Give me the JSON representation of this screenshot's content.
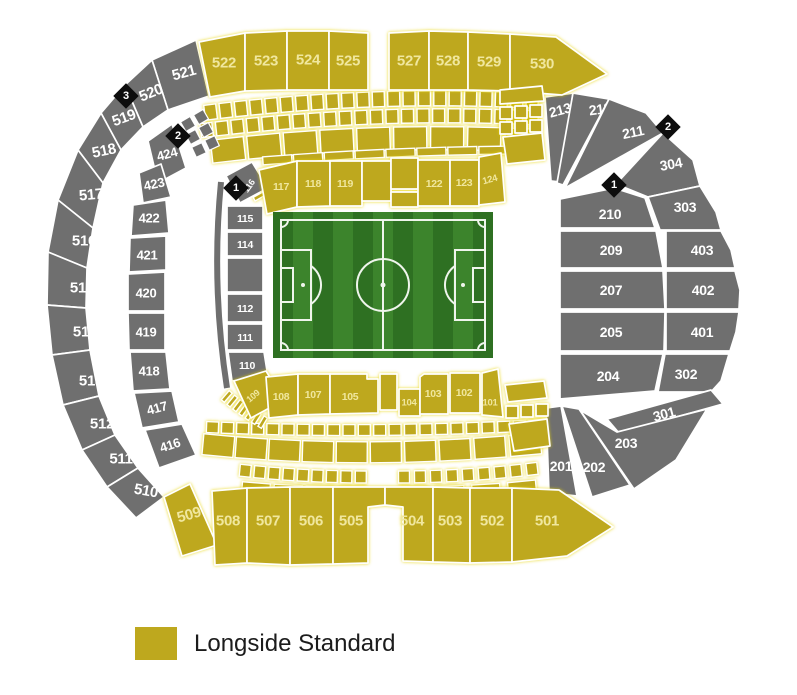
{
  "legend": {
    "items": [
      {
        "label": "Longside Standard",
        "color": "#BEA81E"
      }
    ]
  },
  "colors": {
    "standard": "#BEA81E",
    "standard_label": "#F0E79E",
    "unavailable": "#6F6F6F",
    "unavailable_label": "#FFFFFF",
    "marker_bg": "#0D0D0D",
    "marker_label": "#FFFFFF",
    "pitch_dark": "#2E7022",
    "pitch_light": "#3C842C",
    "pitch_line": "#EFF5EC"
  },
  "map": {
    "sections": [
      {
        "label": "522",
        "type": "standard",
        "pts": "199,42 245,33 245,91 210,97",
        "lx": 224,
        "ly": 63,
        "rot": 0,
        "fs": 15
      },
      {
        "label": "523",
        "type": "standard",
        "pts": "245,33 287,31 287,90 245,91",
        "lx": 266,
        "ly": 61,
        "rot": 0,
        "fs": 15
      },
      {
        "label": "524",
        "type": "standard",
        "pts": "287,31 329,31 329,90 287,90",
        "lx": 308,
        "ly": 60,
        "rot": 0,
        "fs": 15
      },
      {
        "label": "525",
        "type": "standard",
        "pts": "329,31 368,33 368,90 329,90",
        "lx": 348,
        "ly": 61,
        "rot": 0,
        "fs": 15
      },
      {
        "label": "527",
        "type": "standard",
        "pts": "389,33 429,31 429,90 389,90",
        "lx": 409,
        "ly": 61,
        "rot": 0,
        "fs": 15
      },
      {
        "label": "528",
        "type": "standard",
        "pts": "429,31 468,32 468,90 429,90",
        "lx": 448,
        "ly": 61,
        "rot": 0,
        "fs": 15
      },
      {
        "label": "529",
        "type": "standard",
        "pts": "468,32 510,34 510,91 468,90",
        "lx": 489,
        "ly": 62,
        "rot": 0,
        "fs": 15
      },
      {
        "label": "530",
        "type": "standard",
        "pts": "510,34 556,37 607,74 562,95 510,91",
        "lx": 542,
        "ly": 64,
        "rot": 0,
        "fs": 15
      },
      {
        "label": "521",
        "type": "unavailable",
        "pts": "152,60 196,40 209,96 168,110",
        "lx": 184,
        "ly": 73,
        "rot": -15,
        "fs": 15
      },
      {
        "label": "520",
        "type": "unavailable",
        "pts": "125,85 152,60 168,110 143,127",
        "lx": 151,
        "ly": 93,
        "rot": -22,
        "fs": 15
      },
      {
        "label": "519",
        "type": "unavailable",
        "pts": "101,113 125,85 143,127 121,150",
        "lx": 124,
        "ly": 118,
        "rot": -20,
        "fs": 15
      },
      {
        "label": "518",
        "type": "unavailable",
        "pts": "78,150 101,113 121,150 103,183",
        "lx": 104,
        "ly": 151,
        "rot": -12,
        "fs": 15
      },
      {
        "label": "517",
        "type": "unavailable",
        "pts": "58,200 78,150 103,183 93,228",
        "lx": 91,
        "ly": 195,
        "rot": -5,
        "fs": 15
      },
      {
        "label": "516",
        "type": "unavailable",
        "pts": "48,252 58,200 93,228 87,268",
        "lx": 84,
        "ly": 241,
        "rot": 0,
        "fs": 15
      },
      {
        "label": "515",
        "type": "unavailable",
        "pts": "47,305 48,252 87,268 86,308",
        "lx": 82,
        "ly": 288,
        "rot": 0,
        "fs": 15
      },
      {
        "label": "514",
        "type": "unavailable",
        "pts": "52,355 47,305 86,308 90,350",
        "lx": 85,
        "ly": 332,
        "rot": 0,
        "fs": 15
      },
      {
        "label": "513",
        "type": "unavailable",
        "pts": "63,405 52,355 90,350 99,396",
        "lx": 91,
        "ly": 381,
        "rot": 0,
        "fs": 15
      },
      {
        "label": "512",
        "type": "unavailable",
        "pts": "82,450 63,405 99,396 115,435",
        "lx": 102,
        "ly": 424,
        "rot": 0,
        "fs": 15
      },
      {
        "label": "511",
        "type": "unavailable",
        "pts": "107,487 82,450 115,435 138,468",
        "lx": 121,
        "ly": 459,
        "rot": 0,
        "fs": 15
      },
      {
        "label": "510",
        "type": "unavailable",
        "pts": "136,518 107,487 138,468 164,497",
        "lx": 146,
        "ly": 491,
        "rot": 10,
        "fs": 15
      },
      {
        "label": "509",
        "type": "standard",
        "pts": "164,497 190,484 217,545 182,556",
        "lx": 189,
        "ly": 515,
        "rot": -16,
        "fs": 15
      },
      {
        "label": "508",
        "type": "standard",
        "pts": "212,491 247,488 247,563 215,565",
        "lx": 228,
        "ly": 521,
        "rot": 0,
        "fs": 15
      },
      {
        "label": "507",
        "type": "standard",
        "pts": "247,488 290,487 290,565 247,563",
        "lx": 268,
        "ly": 521,
        "rot": 0,
        "fs": 15
      },
      {
        "label": "506",
        "type": "standard",
        "pts": "290,487 333,487 333,564 290,565",
        "lx": 311,
        "ly": 521,
        "rot": 0,
        "fs": 15
      },
      {
        "label": "505",
        "type": "standard",
        "pts": "333,487 385,487 385,505 368,507 368,563 333,564",
        "lx": 351,
        "ly": 521,
        "rot": 0,
        "fs": 15
      },
      {
        "label": "504",
        "type": "standard",
        "pts": "385,487 433,487 433,562 403,561 403,507 385,505",
        "lx": 412,
        "ly": 521,
        "rot": 0,
        "fs": 15
      },
      {
        "label": "503",
        "type": "standard",
        "pts": "433,487 470,488 470,563 433,562",
        "lx": 450,
        "ly": 521,
        "rot": 0,
        "fs": 15
      },
      {
        "label": "502",
        "type": "standard",
        "pts": "470,488 512,488 512,562 470,563",
        "lx": 492,
        "ly": 521,
        "rot": 0,
        "fs": 15
      },
      {
        "label": "501",
        "type": "standard",
        "pts": "512,488 559,490 613,527 567,556 512,562",
        "lx": 547,
        "ly": 521,
        "rot": 0,
        "fs": 15
      },
      {
        "label": "213",
        "type": "unavailable",
        "pts": "545,97 573,93 560,182 551,181",
        "lx": 560,
        "ly": 110,
        "rot": -15,
        "fs": 14
      },
      {
        "label": "212",
        "type": "unavailable",
        "pts": "573,93 609,99 563,185 557,183",
        "lx": 600,
        "ly": 109,
        "rot": -8,
        "fs": 14
      },
      {
        "label": "211",
        "type": "unavailable",
        "pts": "609,99 646,113 663,133 565,188",
        "lx": 633,
        "ly": 132,
        "rot": -12,
        "fs": 14
      },
      {
        "label": "304",
        "type": "unavailable",
        "pts": "663,133 693,160 700,186 648,197 616,184",
        "lx": 671,
        "ly": 164,
        "rot": -10,
        "fs": 14
      },
      {
        "label": "303",
        "type": "unavailable",
        "pts": "648,197 700,186 716,212 721,230 660,230",
        "lx": 685,
        "ly": 207,
        "rot": 0,
        "fs": 14
      },
      {
        "label": "210",
        "type": "unavailable",
        "pts": "560,199 614,188 645,198 655,228 560,228",
        "lx": 610,
        "ly": 214,
        "rot": 0,
        "fs": 14
      },
      {
        "label": "209",
        "type": "unavailable",
        "pts": "560,231 656,231 663,268 560,268",
        "lx": 611,
        "ly": 250,
        "rot": 0,
        "fs": 14
      },
      {
        "label": "403",
        "type": "unavailable",
        "pts": "666,231 721,231 731,250 735,268 666,268",
        "lx": 702,
        "ly": 250,
        "rot": 0,
        "fs": 14
      },
      {
        "label": "207",
        "type": "unavailable",
        "pts": "560,271 663,271 665,309 560,309",
        "lx": 611,
        "ly": 290,
        "rot": 0,
        "fs": 14
      },
      {
        "label": "402",
        "type": "unavailable",
        "pts": "666,271 735,271 740,290 739,309 666,309",
        "lx": 703,
        "ly": 290,
        "rot": 0,
        "fs": 14
      },
      {
        "label": "205",
        "type": "unavailable",
        "pts": "560,312 665,312 664,351 560,351",
        "lx": 611,
        "ly": 332,
        "rot": 0,
        "fs": 14
      },
      {
        "label": "401",
        "type": "unavailable",
        "pts": "666,312 739,312 736,332 730,351 666,351",
        "lx": 702,
        "ly": 332,
        "rot": 0,
        "fs": 14
      },
      {
        "label": "204",
        "type": "unavailable",
        "pts": "560,354 663,354 655,391 560,399",
        "lx": 608,
        "ly": 376,
        "rot": 0,
        "fs": 14
      },
      {
        "label": "302",
        "type": "unavailable",
        "pts": "665,354 729,354 721,381 711,392 658,392",
        "lx": 686,
        "ly": 374,
        "rot": 0,
        "fs": 14
      },
      {
        "label": "301",
        "type": "unavailable",
        "pts": "607,419 711,390 723,404 619,433",
        "lx": 664,
        "ly": 414,
        "rot": -15,
        "fs": 14
      },
      {
        "label": "203",
        "type": "unavailable",
        "pts": "580,410 617,432 707,409 676,460 634,489",
        "lx": 626,
        "ly": 443,
        "rot": 0,
        "fs": 14
      },
      {
        "label": "202",
        "type": "unavailable",
        "pts": "562,406 579,409 630,485 592,497",
        "lx": 594,
        "ly": 467,
        "rot": 0,
        "fs": 14
      },
      {
        "label": "201",
        "type": "unavailable",
        "pts": "546,408 561,406 577,496 549,493",
        "lx": 561,
        "ly": 466,
        "rot": 0,
        "fs": 14
      },
      {
        "label": "424",
        "type": "unavailable",
        "pts": "148,141 172,124 186,168 158,183",
        "lx": 167,
        "ly": 154,
        "rot": -15,
        "fs": 13
      },
      {
        "label": "423",
        "type": "unavailable",
        "pts": "139,173 161,164 171,197 143,203",
        "lx": 154,
        "ly": 184,
        "rot": -12,
        "fs": 13
      },
      {
        "label": "422",
        "type": "unavailable",
        "pts": "133,205 166,200 169,233 131,236",
        "lx": 149,
        "ly": 218,
        "rot": 0,
        "fs": 13
      },
      {
        "label": "421",
        "type": "unavailable",
        "pts": "130,238 166,236 166,270 129,272",
        "lx": 147,
        "ly": 255,
        "rot": 0,
        "fs": 13
      },
      {
        "label": "420",
        "type": "unavailable",
        "pts": "128,274 165,272 165,311 128,311",
        "lx": 146,
        "ly": 293,
        "rot": 0,
        "fs": 13
      },
      {
        "label": "419",
        "type": "unavailable",
        "pts": "128,313 165,313 165,350 129,350",
        "lx": 146,
        "ly": 332,
        "rot": 0,
        "fs": 13
      },
      {
        "label": "418",
        "type": "unavailable",
        "pts": "130,352 166,352 170,389 133,391",
        "lx": 149,
        "ly": 371,
        "rot": 0,
        "fs": 13
      },
      {
        "label": "417",
        "type": "unavailable",
        "pts": "134,393 172,391 179,422 142,428",
        "lx": 157,
        "ly": 408,
        "rot": -15,
        "fs": 13
      },
      {
        "label": "416",
        "type": "unavailable",
        "pts": "145,430 182,424 196,455 159,468",
        "lx": 170,
        "ly": 445,
        "rot": -18,
        "fs": 13
      },
      {
        "label": "116",
        "type": "unavailable",
        "pts": "226,176 252,162 268,188 240,203",
        "lx": 249,
        "ly": 186,
        "rot": -55,
        "fs": 9
      },
      {
        "label": "115",
        "type": "unavailable",
        "pts": "227,206 263,206 263,230 227,230",
        "lx": 245,
        "ly": 219,
        "rot": 0,
        "fs": 10.5
      },
      {
        "label": "114",
        "type": "unavailable",
        "pts": "227,232 263,232 263,256 227,256",
        "lx": 245,
        "ly": 245,
        "rot": 0,
        "fs": 10.5
      },
      {
        "label": "",
        "type": "unavailable",
        "pts": "227,258 263,258 263,292 227,292"
      },
      {
        "label": "112",
        "type": "unavailable",
        "pts": "227,294 263,294 263,322 227,322",
        "lx": 245,
        "ly": 309,
        "rot": 0,
        "fs": 10.5
      },
      {
        "label": "111",
        "type": "unavailable",
        "pts": "227,324 263,324 263,350 227,350",
        "lx": 245,
        "ly": 338,
        "rot": 0,
        "fs": 10.5
      },
      {
        "label": "110",
        "type": "unavailable",
        "pts": "228,352 264,352 268,377 232,381",
        "lx": 247,
        "ly": 366,
        "rot": 0,
        "fs": 10.5
      },
      {
        "label": "117",
        "type": "standard",
        "pts": "259,170 297,161 297,207 267,214",
        "lx": 281,
        "ly": 187,
        "rot": 0,
        "fs": 10.5
      },
      {
        "label": "118",
        "type": "standard",
        "pts": "297,161 330,161 330,206 297,207",
        "lx": 313,
        "ly": 184,
        "rot": 0,
        "fs": 10.5
      },
      {
        "label": "119",
        "type": "standard",
        "pts": "330,161 362,161 362,206 330,206",
        "lx": 345,
        "ly": 184,
        "rot": 0,
        "fs": 10.5
      },
      {
        "label": "",
        "type": "standard",
        "pts": "362,161 391,161 391,201 362,201"
      },
      {
        "label": "",
        "type": "standard",
        "pts": "391,158 418,158 418,189 391,189"
      },
      {
        "label": "",
        "type": "standard",
        "pts": "391,192 418,192 418,207 391,207"
      },
      {
        "label": "122",
        "type": "standard",
        "pts": "418,160 450,160 450,206 418,206",
        "lx": 434,
        "ly": 184,
        "rot": 0,
        "fs": 10.5
      },
      {
        "label": "123",
        "type": "standard",
        "pts": "450,160 479,160 479,206 450,206",
        "lx": 464,
        "ly": 183,
        "rot": 0,
        "fs": 10.5
      },
      {
        "label": "124",
        "type": "standard",
        "pts": "479,157 501,153 505,202 479,205",
        "lx": 490,
        "ly": 180,
        "rot": -15,
        "fs": 9.5
      },
      {
        "label": "",
        "type": "standard",
        "pts": "500,90 542,86 544,101 500,104"
      },
      {
        "label": "",
        "type": "standard",
        "pts": "500,107 512,107 512,119 500,119"
      },
      {
        "label": "",
        "type": "standard",
        "pts": "515,106 527,106 527,118 515,118"
      },
      {
        "label": "",
        "type": "standard",
        "pts": "530,105 542,105 542,117 530,117"
      },
      {
        "label": "",
        "type": "standard",
        "pts": "500,122 512,122 512,134 500,134"
      },
      {
        "label": "",
        "type": "standard",
        "pts": "515,121 527,121 527,133 515,133"
      },
      {
        "label": "",
        "type": "standard",
        "pts": "530,120 542,120 542,132 530,132"
      },
      {
        "label": "",
        "type": "standard",
        "pts": "503,137 542,133 545,160 507,164"
      },
      {
        "label": "109",
        "type": "standard",
        "pts": "234,381 266,371 284,400 251,418",
        "lx": 253,
        "ly": 396,
        "rot": -40,
        "fs": 9
      },
      {
        "label": "108",
        "type": "standard",
        "pts": "266,377 298,374 298,415 269,418",
        "lx": 281,
        "ly": 397,
        "rot": 0,
        "fs": 10.5
      },
      {
        "label": "107",
        "type": "standard",
        "pts": "298,374 330,374 330,414 298,415",
        "lx": 313,
        "ly": 395,
        "rot": 0,
        "fs": 10.5
      },
      {
        "label": "105",
        "type": "standard",
        "pts": "330,374 367,374 367,379 378,379 378,413 330,414",
        "lx": 350,
        "ly": 397,
        "rot": 0,
        "fs": 10.5
      },
      {
        "label": "",
        "type": "standard",
        "pts": "380,374 397,374 397,410 380,410"
      },
      {
        "label": "104",
        "type": "standard",
        "pts": "399,389 420,389 420,416 399,416",
        "lx": 409,
        "ly": 403,
        "rot": 0,
        "fs": 9.5
      },
      {
        "label": "103",
        "type": "standard",
        "pts": "420,377 424,374 448,374 448,414 420,414",
        "lx": 433,
        "ly": 394,
        "rot": 0,
        "fs": 10.5
      },
      {
        "label": "102",
        "type": "standard",
        "pts": "450,373 480,373 480,413 450,413",
        "lx": 464,
        "ly": 393,
        "rot": 0,
        "fs": 10.5
      },
      {
        "label": "101",
        "type": "standard",
        "pts": "482,373 498,369 503,417 482,415",
        "lx": 490,
        "ly": 403,
        "rot": 0,
        "fs": 9.5
      },
      {
        "label": "",
        "type": "standard",
        "pts": "505,385 544,381 547,398 508,402"
      },
      {
        "label": "",
        "type": "standard",
        "pts": "506,406 518,406 518,418 506,418"
      },
      {
        "label": "",
        "type": "standard",
        "pts": "521,405 533,405 533,417 521,417"
      },
      {
        "label": "",
        "type": "standard",
        "pts": "536,404 548,404 548,416 536,416"
      },
      {
        "label": "",
        "type": "standard",
        "pts": "509,424 547,419 550,446 514,451"
      }
    ],
    "markers": [
      {
        "label": "3",
        "x": 126,
        "y": 96
      },
      {
        "label": "2",
        "x": 178,
        "y": 136
      },
      {
        "label": "1",
        "x": 236,
        "y": 188
      },
      {
        "label": "1",
        "x": 614,
        "y": 185
      },
      {
        "label": "2",
        "x": 668,
        "y": 127
      }
    ]
  }
}
